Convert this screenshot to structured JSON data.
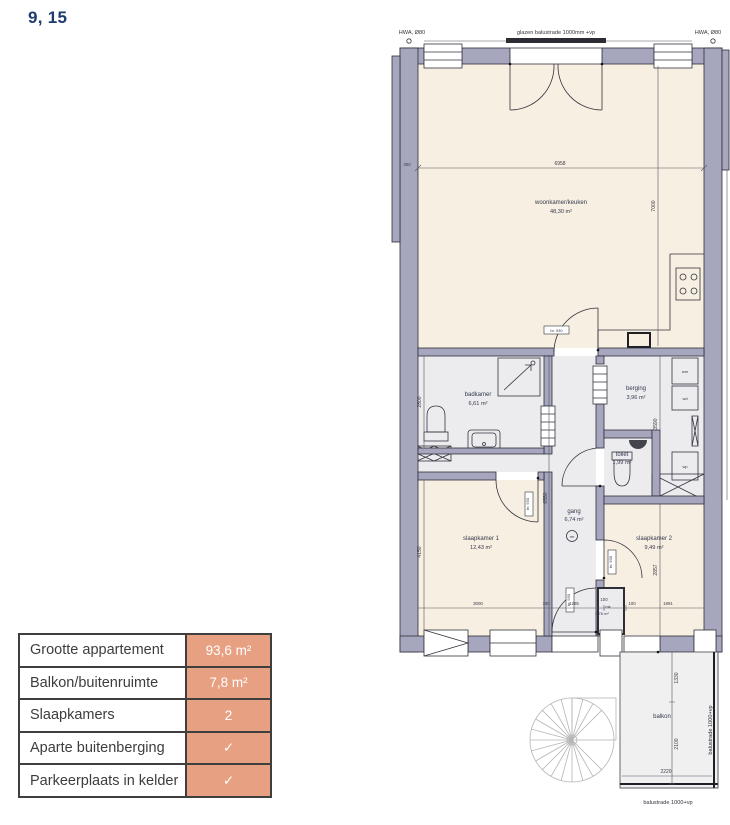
{
  "title": "9, 15",
  "info_table": {
    "rows": [
      {
        "label": "Grootte appartement",
        "value": "93,6 m²"
      },
      {
        "label": "Balkon/buitenruimte",
        "value": "7,8 m²"
      },
      {
        "label": "Slaapkamers",
        "value": "2"
      },
      {
        "label": "Aparte buitenberging",
        "value": "✓"
      },
      {
        "label": "Parkeerplaats in kelder",
        "value": "✓"
      }
    ],
    "accent_color": "#e8a083"
  },
  "floorplan": {
    "rooms": [
      {
        "name": "woonkamer/keuken",
        "area": "48,30 m²"
      },
      {
        "name": "badkamer",
        "area": "6,61 m²"
      },
      {
        "name": "berging",
        "area": "3,96 m²"
      },
      {
        "name": "toilet",
        "area": "1,99 m²"
      },
      {
        "name": "gang",
        "area": "6,74 m²"
      },
      {
        "name": "slaapkamer 1",
        "area": "12,43 m²"
      },
      {
        "name": "slaapkamer 2",
        "area": "9,49 m²"
      },
      {
        "name": "balkon",
        "area": ""
      },
      {
        "name": "mk",
        "area": "0,76 m²"
      }
    ],
    "labels": {
      "hwa": "HWA, Ø80",
      "glazen_balustrade": "glazen balustrade 1000mm +vp",
      "balustrade": "balustrade 1000+vp",
      "wm": "wm",
      "wd": "wd",
      "wp": "wp",
      "rm": "rm",
      "door_tag": "br. 930"
    },
    "dimensions": {
      "living_width": "6958",
      "left_wall": "300",
      "living_height": "7000",
      "badkamer_height": "2800",
      "berging_height": "3590",
      "gang_height": "6550",
      "sk1_height": "4150",
      "sk2_height": "2857",
      "bottom_segments": [
        "3000",
        "100",
        "1295",
        "100",
        "100",
        "1891"
      ],
      "balcony_top": "1330",
      "balcony_bottom": "2100",
      "balcony_width": "2220"
    },
    "colors": {
      "wall": "#a6a6be",
      "floor": "#f7efe2",
      "wet_floor": "#ececef",
      "balcony_floor": "#f0f0f0"
    }
  }
}
